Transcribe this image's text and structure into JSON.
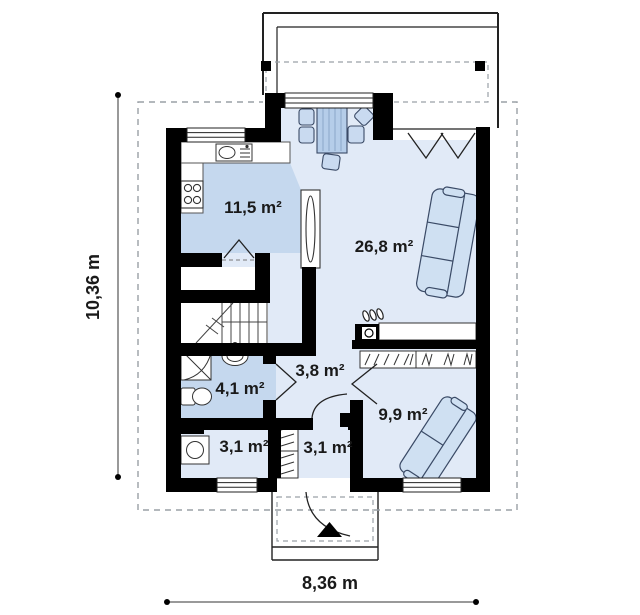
{
  "plan": {
    "rooms": [
      {
        "id": "kitchen",
        "area_label": "11,5 m²"
      },
      {
        "id": "living-dining",
        "area_label": "26,8 m²"
      },
      {
        "id": "bathroom",
        "area_label": "4,1 m²"
      },
      {
        "id": "hallway",
        "area_label": "3,8 m²"
      },
      {
        "id": "bedroom",
        "area_label": "9,9 m²"
      },
      {
        "id": "utility",
        "area_label": "3,1 m²"
      },
      {
        "id": "entrance-hall",
        "area_label": "3,1 m²"
      }
    ],
    "dimensions": {
      "height_label": "10,36 m",
      "width_label": "8,36 m"
    },
    "colors": {
      "wall": "#000000",
      "floor_light": "#e1eaf7",
      "floor_medium": "#c5d8ee",
      "furniture_fill": "#cfe0f2",
      "table_fill": "#b5cde9",
      "chair_fill": "#c9daf0",
      "outline": "#2f3b52",
      "dashed_line": "#9aa0a6"
    }
  }
}
